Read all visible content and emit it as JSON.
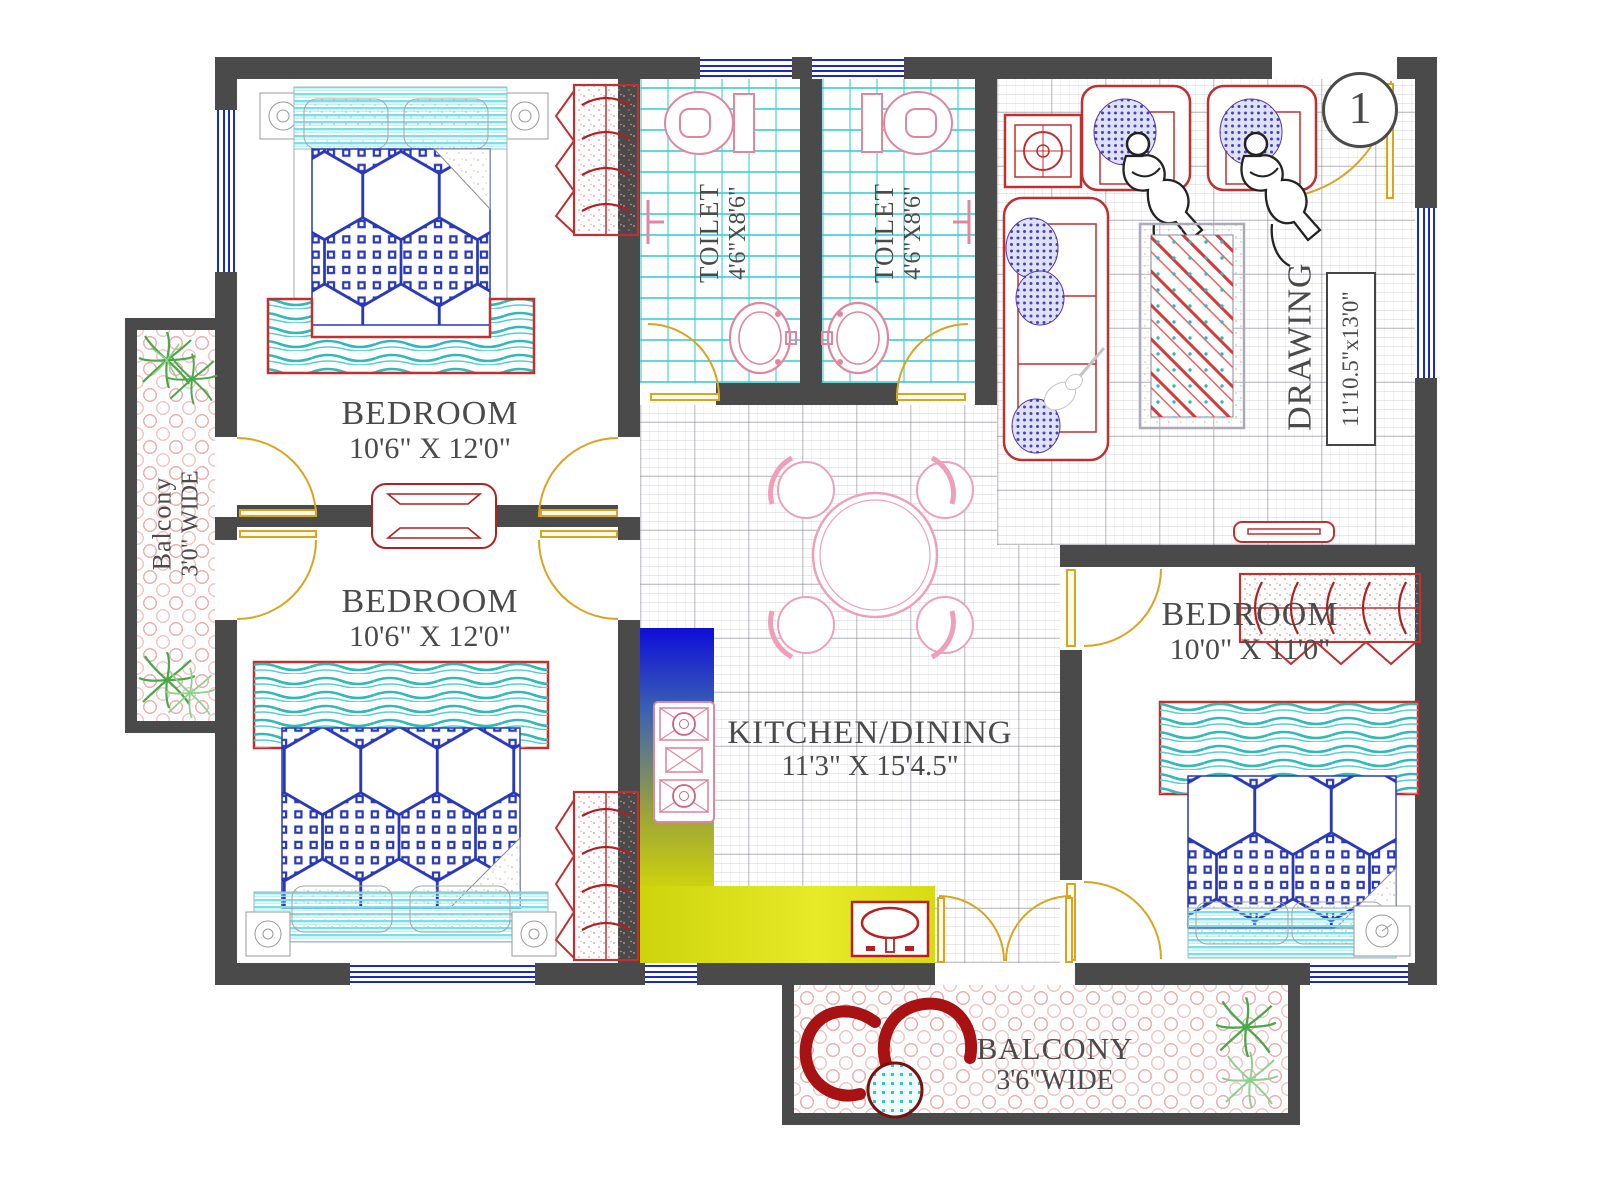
{
  "plan": {
    "unit_number": "1",
    "rooms": {
      "bedroom_top_left": {
        "name": "BEDROOM",
        "dims": "10'6\" X 12'0\""
      },
      "bedroom_mid_left": {
        "name": "BEDROOM",
        "dims": "10'6\" X 12'0\""
      },
      "bedroom_right": {
        "name": "BEDROOM",
        "dims": "10'0\" X 11'0\""
      },
      "toilet_left": {
        "name": "TOILET",
        "dims": "4'6\"X8'6\""
      },
      "toilet_right": {
        "name": "TOILET",
        "dims": "4'6\"X8'6\""
      },
      "drawing": {
        "name": "DRAWING",
        "dims": "11'10.5\"x13'0\""
      },
      "kitchen_dining": {
        "name": "KITCHEN/DINING",
        "dims": "11'3\" X 15'4.5\""
      },
      "balcony_left": {
        "name": "Balcony",
        "dims": "3'0\" WIDE"
      },
      "balcony_bottom": {
        "name": "BALCONY",
        "dims": "3'6\"WIDE"
      }
    },
    "colors": {
      "wall": "#4a4a4a",
      "door": "#d9a520",
      "furniture_red": "#c03030",
      "hex_blue": "#2838b8",
      "teal": "#2fb9b9",
      "tile_cyan": "#3ccdd2",
      "counter_blue": "#0d0dd8",
      "counter_yellow": "#cfd40a",
      "star_red": "#e46060",
      "fixture_pink": "#e087a0",
      "window_blue": "#1b2ac0",
      "label_text": "#4a4a4a"
    }
  }
}
